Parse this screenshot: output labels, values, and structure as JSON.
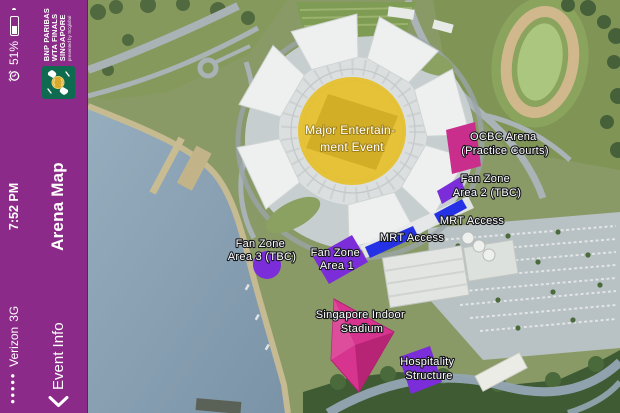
{
  "statusbar": {
    "signal_dots": "●●●●●",
    "carrier": "Verizon",
    "network": "3G",
    "time": "7:52 PM",
    "battery_percent": "51%",
    "icons": {
      "alarm": "alarm-clock",
      "battery": "battery-half"
    }
  },
  "navbar": {
    "back_label": "Event Info",
    "title": "Arena Map",
    "back_icon": "chevron-left",
    "logo": {
      "line1": "BNP PARIBAS",
      "line2": "WTA FINALS",
      "line3": "SINGAPORE",
      "line4": "presented by SCglobal"
    }
  },
  "map": {
    "labels": {
      "major_event": {
        "line1": "Major Entertain-",
        "line2": "ment Event"
      },
      "ocbc_arena": {
        "line1": "OCBC Arena",
        "line2": "(Practice Courts)"
      },
      "fan_zone_2": {
        "line1": "Fan Zone",
        "line2": "Area 2 (TBC)"
      },
      "mrt_access_upper": {
        "line1": "MRT Access"
      },
      "mrt_access_lower": {
        "line1": "MRT Access"
      },
      "fan_zone_3": {
        "line1": "Fan Zone",
        "line2": "Area 3 (TBC)"
      },
      "fan_zone_1": {
        "line1": "Fan Zone",
        "line2": "Area 1"
      },
      "indoor_stadium": {
        "line1": "Singapore Indoor",
        "line2": "Stadium"
      },
      "hospitality": {
        "line1": "Hospitality",
        "line2": "Structure"
      }
    },
    "colors": {
      "zone_yellow": "#e5bf2b",
      "zone_pink": "#c92e8d",
      "zone_purple": "#7a2dd8",
      "zone_blue": "#2531e4",
      "sidebar_purple": "#8b2a88"
    }
  }
}
